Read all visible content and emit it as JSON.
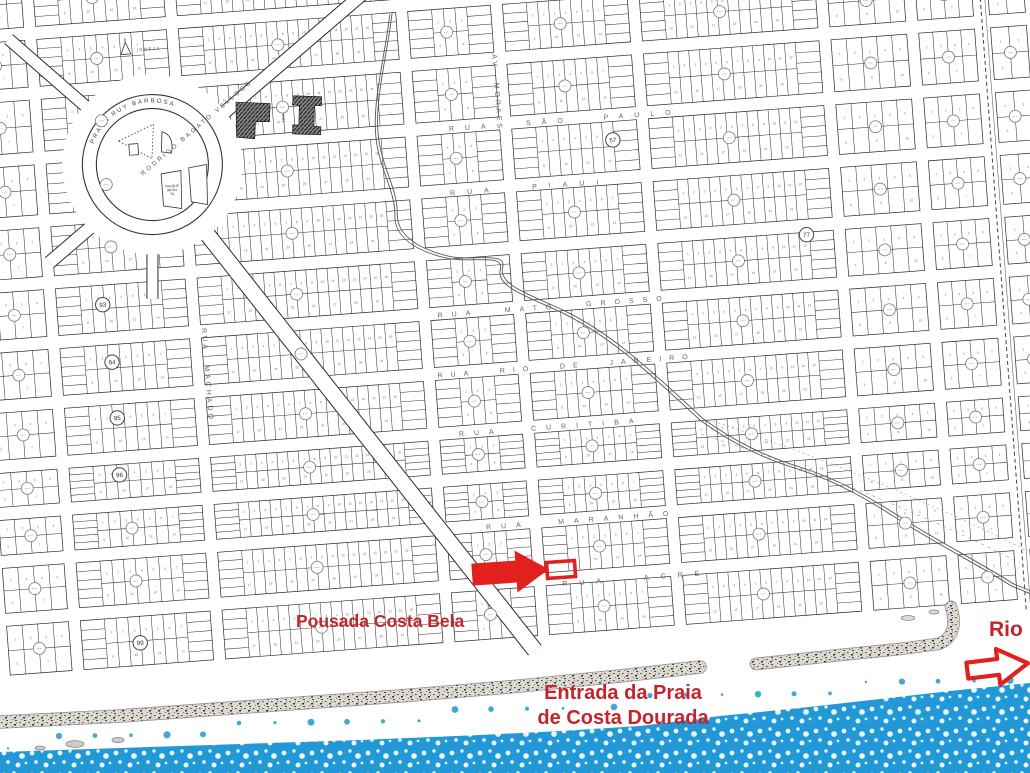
{
  "colors": {
    "red_shape": "#e2201d",
    "red_text": "#c4242b",
    "water_blue": "#2398d6",
    "sand_base": "#ddd8d0",
    "ink": "#3a3a3a"
  },
  "annotations": {
    "pousada": "Pousada Costa Bela",
    "entrada_line1": "Entrada da Praia",
    "entrada_line2": "de Costa Dourada",
    "rio": "Rio"
  },
  "map": {
    "plaza": {
      "label": "PRAÇA RUY BARBOSA",
      "cx": 170,
      "cy": 138
    },
    "church_label": "IGREJA",
    "playground_lines": [
      "PARQUE",
      "INFAN-",
      "TIL"
    ],
    "gym_label": "GINASIO",
    "diagonal_street": {
      "label": "RODRIGO BAGATO VELLOSO",
      "x": 218,
      "y": 106,
      "angle": -36
    },
    "streets": [
      {
        "label": "RUA SÃO PAULO",
        "x": 585,
        "y": 127,
        "ls": 11
      },
      {
        "label": "RUA PIAUI",
        "x": 545,
        "y": 191,
        "ls": 12
      },
      {
        "label": "RUA MATO GROSSO",
        "x": 560,
        "y": 312,
        "ls": 9
      },
      {
        "label": "RUA RIO DE JANEIRO",
        "x": 568,
        "y": 372,
        "ls": 8
      },
      {
        "label": "RUA CURITIBA",
        "x": 548,
        "y": 432,
        "ls": 10
      },
      {
        "label": "RUA MARANHÃO",
        "x": 572,
        "y": 527,
        "ls": 10
      },
      {
        "label": "RUA ACRE",
        "x": 622,
        "y": 589,
        "ls": 12
      },
      {
        "label": "RUA MACHADO",
        "x": 207,
        "y": 352,
        "ls": 3,
        "vertical": true
      },
      {
        "label": "AV MORAES",
        "x": 517,
        "y": 92,
        "ls": 3,
        "vertical": true
      }
    ],
    "block_numbers": [
      {
        "n": "93",
        "x": 110,
        "y": 274
      },
      {
        "n": "94",
        "x": 115,
        "y": 332
      },
      {
        "n": "95",
        "x": 116,
        "y": 388
      },
      {
        "n": "96",
        "x": 114,
        "y": 445
      },
      {
        "n": "99",
        "x": 122,
        "y": 614
      },
      {
        "n": "57",
        "x": 631,
        "y": 148
      },
      {
        "n": "77",
        "x": 817,
        "y": 257
      }
    ]
  }
}
